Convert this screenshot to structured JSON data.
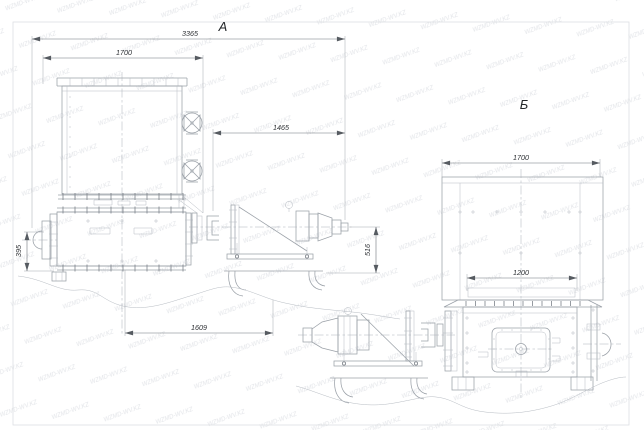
{
  "watermark": {
    "text": "WZMD-WV.KZ"
  },
  "views": {
    "a": {
      "label": "A",
      "dims": {
        "overall_length": "3365",
        "hopper_width": "1700",
        "drive_reach": "1465",
        "inlet_height": "395",
        "base_span": "1609",
        "axis_height": "516"
      }
    },
    "b": {
      "label": "Б",
      "dims": {
        "hopper_width": "1700",
        "opening_width": "1200"
      }
    }
  },
  "colors": {
    "line": "#9ba1a8",
    "dim_text": "#2e3135",
    "watermark": "#c6cad2"
  }
}
